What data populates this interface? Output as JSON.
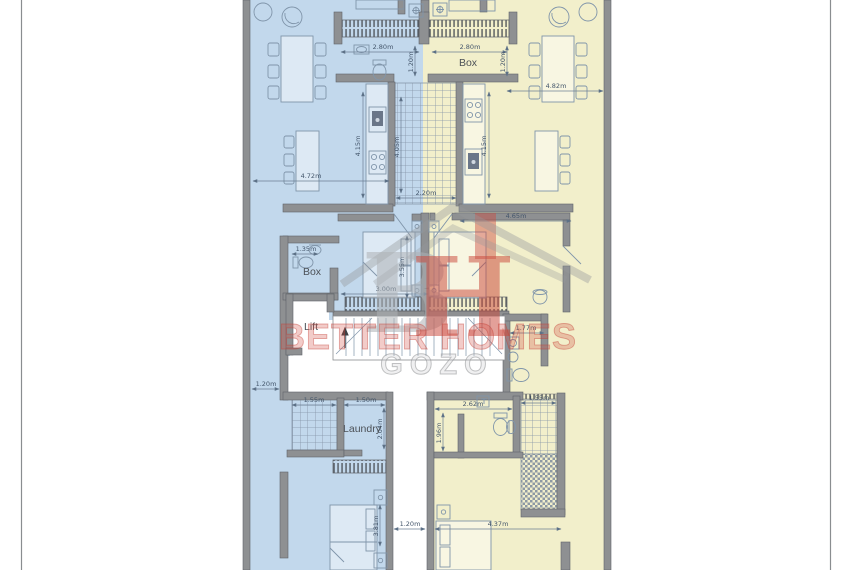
{
  "labels": {
    "box_right": "Box",
    "box_left": "Box",
    "lift": "Lift",
    "laundry": "Laundry"
  },
  "watermark": {
    "logo_b": "B",
    "logo_h": "H",
    "name": "BETTER HOMES",
    "location": "GOZO"
  },
  "dimensions": {
    "d280_left": "2.80m",
    "d280_right": "2.80m",
    "d120v_left": "1.20m",
    "d120v_right": "1.20m",
    "d415v_left": "4.15m",
    "d405v_shaft": "4.05m",
    "d415v_right": "4.15m",
    "d220_shaft": "2.20m",
    "d472_left": "4.72m",
    "d482_right": "4.82m",
    "d465_right": "4.65m",
    "d300_left": "3.00m",
    "d355v_left": "3.55m",
    "d135_left": "1.35m",
    "d177_right": "1.77m",
    "d120_alley": "1.20m",
    "d155_left": "1.55m",
    "d150_laundry": "1.50m",
    "d204v_laundry": "2.04m",
    "d262_right": "2.62m",
    "d196v_right": "1.96m",
    "d155_right": "1.55m",
    "d120_gap": "1.20m",
    "d437_right": "4.37m",
    "d381v_left": "3.81m"
  },
  "colors": {
    "unit_left_fill": "#c2d8ec",
    "unit_right_fill": "#f2efcb",
    "wall": "#8e9092",
    "dim_text": "#44566b",
    "watermark_red": "#cf4b40",
    "watermark_gray": "#a9abad"
  }
}
